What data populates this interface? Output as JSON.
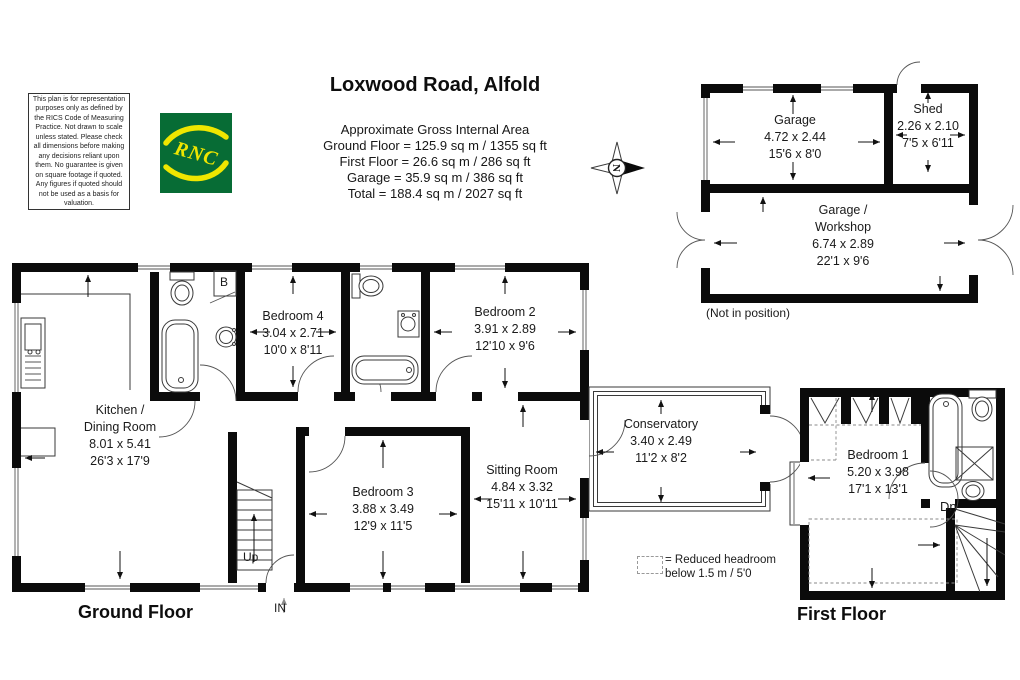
{
  "title": "Loxwood Road, Alfold",
  "disclaimer": "This plan is for representation purposes only as defined by the RICS Code of Measuring Practice. Not drawn to scale unless stated. Please check all dimensions before making any decisions reliant upon them. No guarantee is given on square footage if quoted. Any figures if quoted should not be used as a basis for valuation.",
  "logo": {
    "text": "RNC"
  },
  "compass": {
    "label": "N"
  },
  "area_summary": {
    "heading": "Approximate Gross Internal Area",
    "lines": [
      "Ground Floor = 125.9 sq m / 1355 sq ft",
      "First Floor = 26.6 sq m / 286 sq ft",
      "Garage = 35.9 sq m / 386 sq ft",
      "Total = 188.4 sq m / 2027 sq ft"
    ]
  },
  "floor_labels": {
    "ground": "Ground Floor",
    "first": "First Floor"
  },
  "outbuilding_note": "(Not in position)",
  "legend": {
    "line1": "= Reduced headroom",
    "line2": "below 1.5 m / 5'0"
  },
  "markers": {
    "up": "Up",
    "in": "IN",
    "down": "Dn",
    "boiler": "B"
  },
  "rooms": {
    "kitchen": {
      "name1": "Kitchen /",
      "name2": "Dining Room",
      "metric": "8.01 x 5.41",
      "imperial": "26'3 x 17'9"
    },
    "bedroom4": {
      "name": "Bedroom 4",
      "metric": "3.04 x 2.71",
      "imperial": "10'0 x 8'11"
    },
    "bedroom2": {
      "name": "Bedroom 2",
      "metric": "3.91 x 2.89",
      "imperial": "12'10 x 9'6"
    },
    "bedroom3": {
      "name": "Bedroom 3",
      "metric": "3.88 x 3.49",
      "imperial": "12'9 x 11'5"
    },
    "sitting_room": {
      "name": "Sitting Room",
      "metric": "4.84 x 3.32",
      "imperial": "15'11 x 10'11"
    },
    "conservatory": {
      "name": "Conservatory",
      "metric": "3.40 x 2.49",
      "imperial": "11'2 x 8'2"
    },
    "bedroom1": {
      "name": "Bedroom 1",
      "metric": "5.20 x 3.98",
      "imperial": "17'1 x 13'1"
    },
    "garage": {
      "name": "Garage",
      "metric": "4.72 x 2.44",
      "imperial": "15'6 x 8'0"
    },
    "shed": {
      "name": "Shed",
      "metric": "2.26 x 2.10",
      "imperial": "7'5 x 6'11"
    },
    "workshop": {
      "name1": "Garage /",
      "name2": "Workshop",
      "metric": "6.74 x 2.89",
      "imperial": "22'1 x 9'6"
    }
  },
  "colors": {
    "wall": "#0b0b0b",
    "logo_green": "#076c35",
    "logo_yellow": "#efe600"
  }
}
